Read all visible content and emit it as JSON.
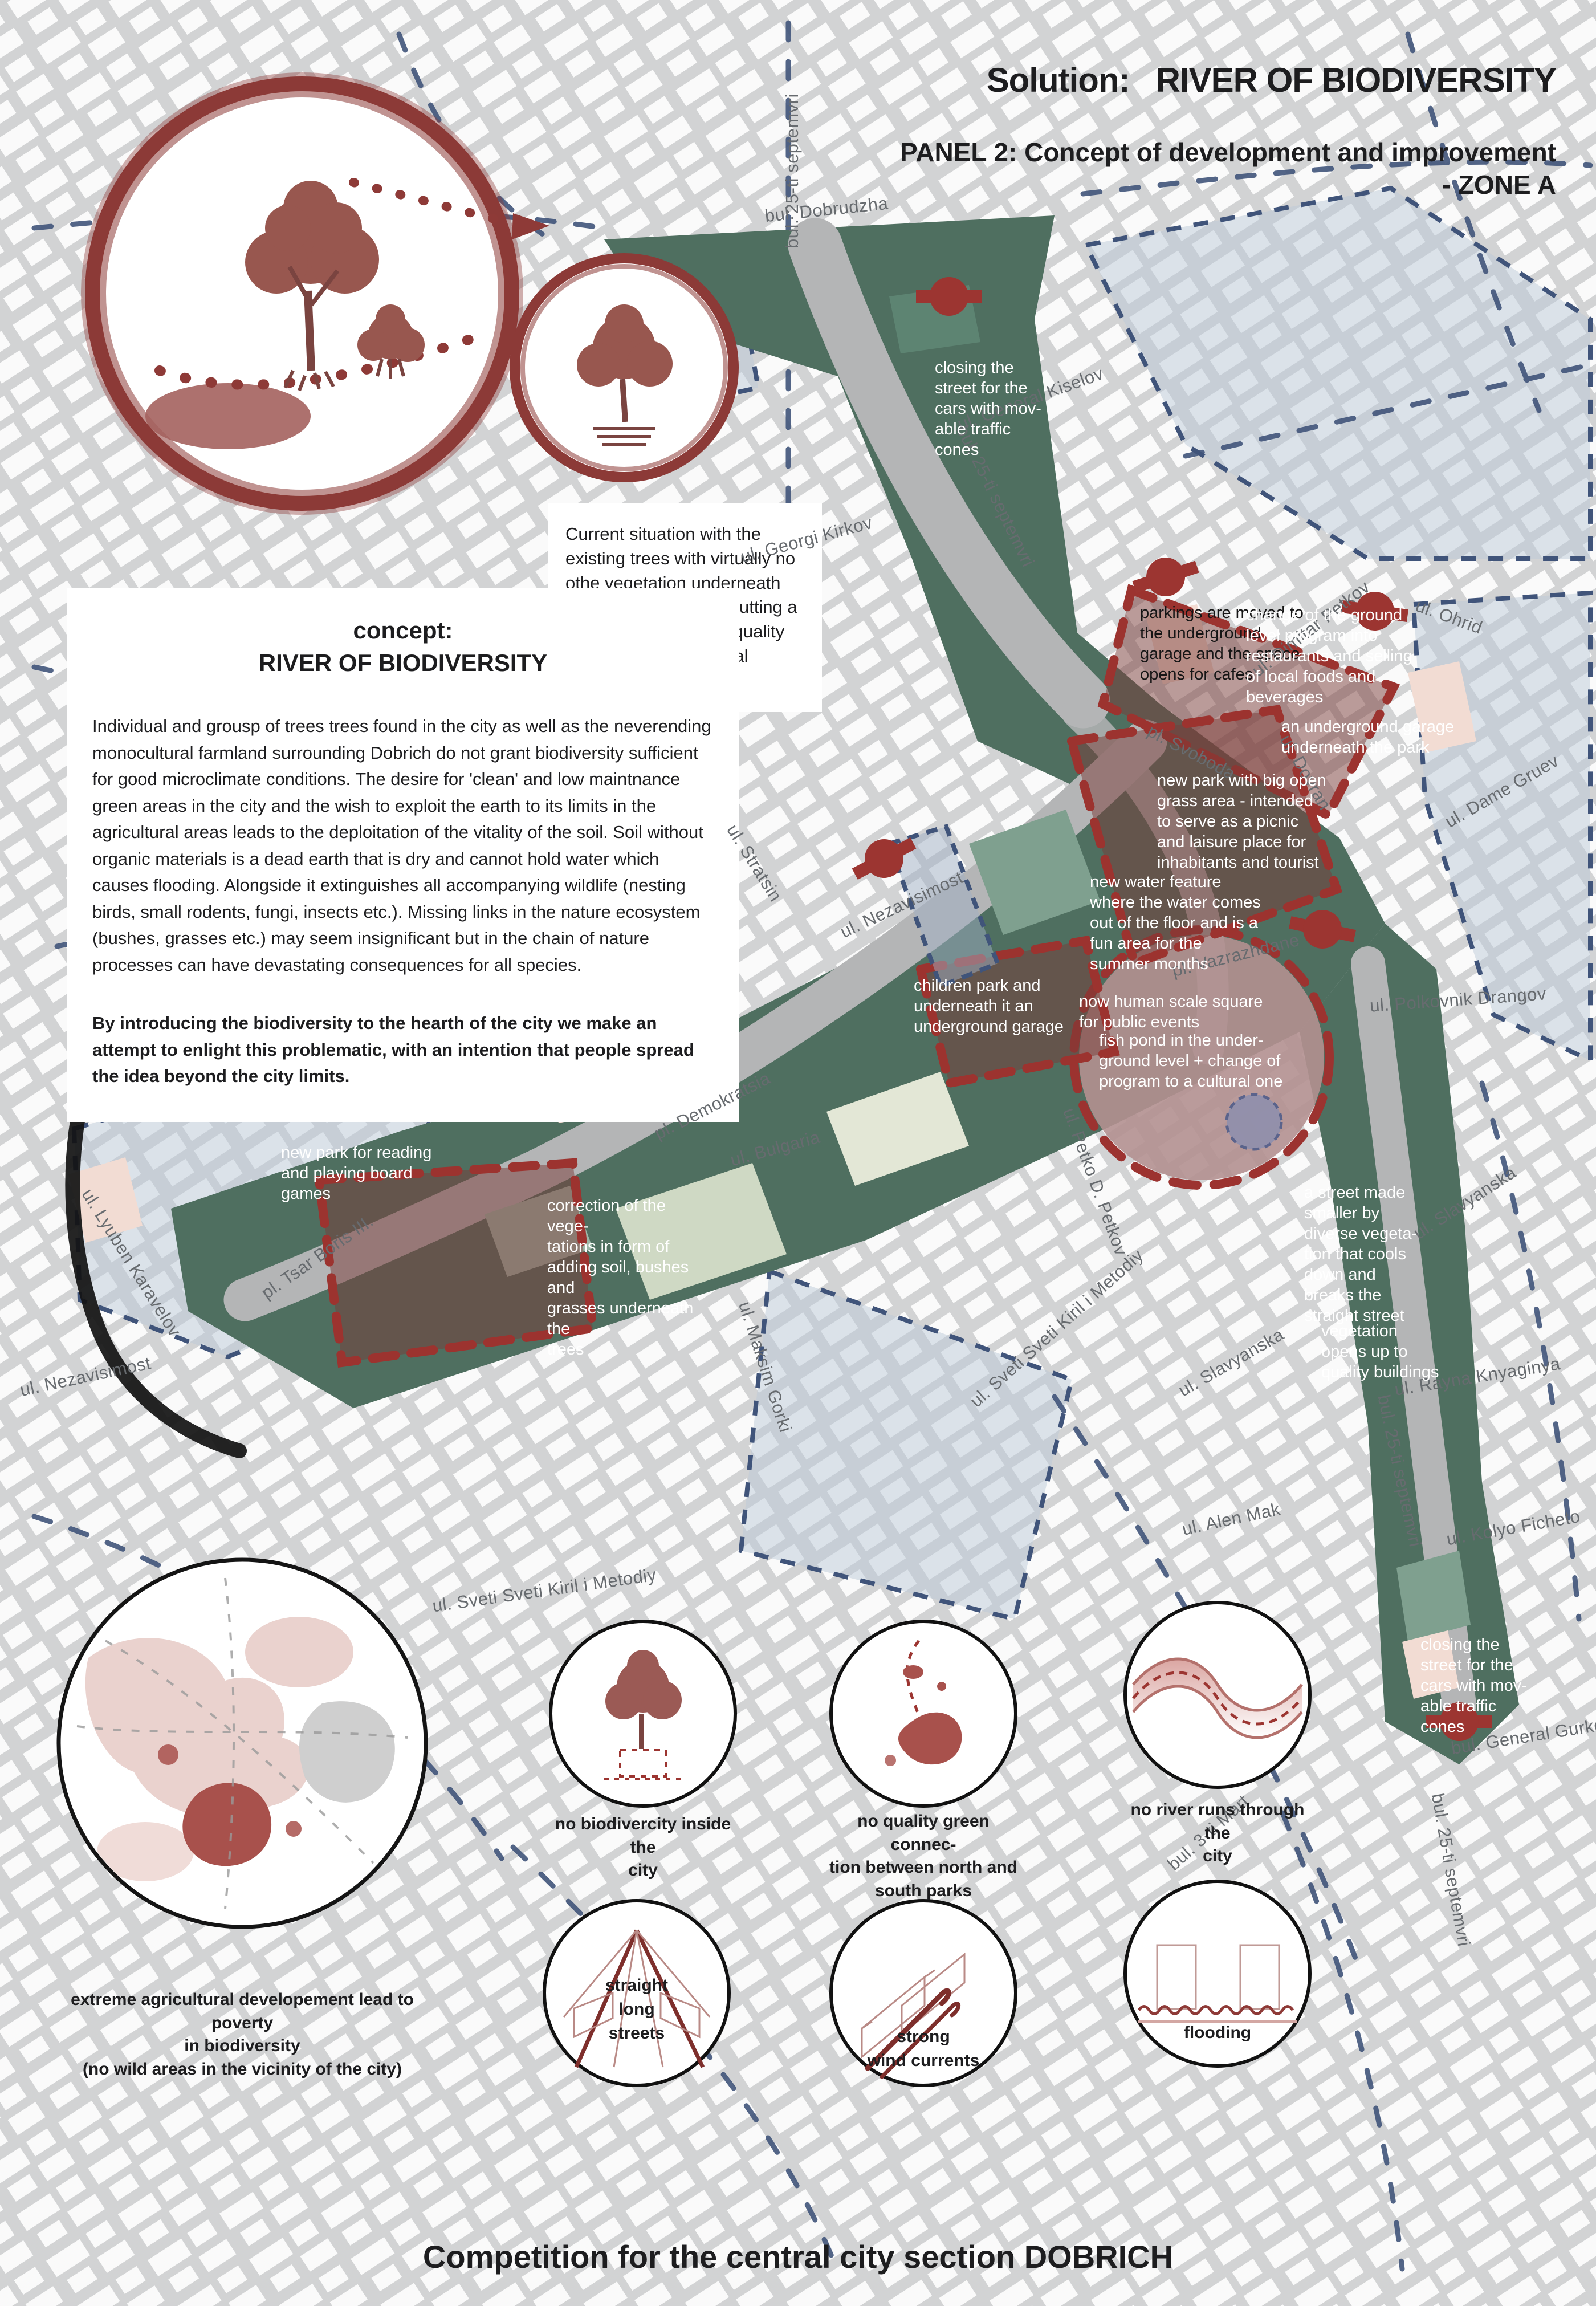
{
  "header": {
    "solution_label": "Solution:",
    "solution_title": "RIVER OF BIODIVERSITY",
    "panel_line": "PANEL 2: Concept of development and improvement",
    "zone_line": "- ZONE A"
  },
  "concept": {
    "heading": "concept:\nRIVER OF BIODIVERSITY",
    "body": "Individual and grousp of trees trees found in the city as well as the neverending monocultural farmland surrounding Dobrich do not grant biodiversity sufficient for good microclimate conditions. The desire for 'clean' and low maintnance green areas in the city and the wish to exploit the earth to its limits in the agricultural areas leads to the deploitation of the vitality of the soil. Soil without organic materials is a dead earth that is dry and cannot hold water which causes flooding. Alongside it extinguishes all accompanying wildlife (nesting birds, small rodents, fungi, insects etc.). Missing links in the nature ecosystem (bushes, grasses etc.) may seem insignificant but in the chain of nature processes can have devastating consequences for all species.",
    "emphasis": "By introducing the biodiversity to the hearth of the city we make an attempt to enlight this problematic, with an intention that people spread the idea beyond the city limits."
  },
  "notes": {
    "current_situation": "Current situation with the existing trees with virtually no othe vegetation underneath them is corrected by putting a foil and 15cm of high quality soil, alongside the local bushes and grasses."
  },
  "map": {
    "annotations": [
      {
        "text": "closing the\nstreet for the\ncars with mov-\nable traffic\ncones",
        "tone": "light"
      },
      {
        "text": "parkings are moved to\nthe underground\ngarage and the space\nopens for cafes",
        "tone": "dark"
      },
      {
        "text": "change of the ground\nlevel program into\nrestaurants and selling\nof local foods and\nbeverages",
        "tone": "light"
      },
      {
        "text": "an underground garage\nunderneath the park",
        "tone": "light"
      },
      {
        "text": "new park with big open\ngrass area - intended\nto serve as a picnic\nand laisure place for\ninhabitants and tourist",
        "tone": "light"
      },
      {
        "text": "new water feature\nwhere the water comes\nout of the floor and is a\nfun area for the\nsummer months",
        "tone": "light"
      },
      {
        "text": "children park and\nunderneath it an\nunderground garage",
        "tone": "light"
      },
      {
        "text": "now human scale square\nfor public events",
        "tone": "light"
      },
      {
        "text": "fish pond in the under-\nground level + change of\nprogram to a cultural one",
        "tone": "light"
      },
      {
        "text": "new park for reading\nand playing board\ngames",
        "tone": "light"
      },
      {
        "text": "correction of the vege-\ntations in form of\nadding soil, bushes and\ngrasses underneath the\ntrees",
        "tone": "light"
      },
      {
        "text": "a street made\nsmaller by\ndiverse vegeta-\ntion that cools\ndown and\nbreaks the\nstraight street",
        "tone": "light"
      },
      {
        "text": "vegetation\nopens up to\nquality buildings",
        "tone": "light"
      },
      {
        "text": "closing the\nstreet for the\ncars with mov-\nable traffic\ncones",
        "tone": "light"
      }
    ],
    "street_labels": [
      "bul. 25-ti septemvri",
      "bul. Dobrudzha",
      "ul. Georgi Kirkov",
      "ul. General Kiselov",
      "bul. 25-ti septemvri",
      "ul. Dimitar Petkov",
      "ul. Ohrid",
      "ul. Dame Gruev",
      "pl. Svoboda",
      "ul. Doyran",
      "pl. Vazrazhdane",
      "ul. Polkovnik Drangov",
      "ul. Stratsin",
      "ul. Nezavisimost",
      "pl. Demokratsia",
      "ul. Bulgaria",
      "ul. Petko D. Petkov",
      "ul. Maksim Gorki",
      "ul. Sveti Sveti Kiril i Metodiy",
      "ul. Slavyanska",
      "ul. Rayna Knyaginya",
      "ul. Alen Mak",
      "ul. Kolyo Ficheto",
      "bul. 25-ti septemvri",
      "bul. General Gurko",
      "bul. 3-ti Mart",
      "ul. Sveti Sveti Kiril i Metodiy",
      "ul. Nezavisimost",
      "ul. Lyuben Karavelov",
      "pl. Tsar Boris III.",
      "ul. Slavyanska",
      "bul. 25-ti septemvri"
    ]
  },
  "insets": {
    "problems": [
      {
        "caption": "no biodivercity inside the\ncity"
      },
      {
        "caption": "no quality green connec-\ntion between north and\nsouth parks"
      },
      {
        "caption": "no river runs through the\ncity"
      }
    ],
    "big_circle_caption": "extreme agricultural developement lead to poverty\nin biodiversity\n(no wild areas in the vicinity of the city)",
    "sketches": [
      {
        "label": "straight\nlong\nstreets"
      },
      {
        "label": "strong\nwind currents"
      },
      {
        "label": "flooding"
      }
    ]
  },
  "footer": {
    "title": "Competition for the central city section DOBRICH"
  },
  "colors": {
    "park_green": "#4f6f60",
    "accent_red": "#9c3531",
    "overlay_redbrown": "rgba(122,60,56,0.5)",
    "navy_dash": "#40547a",
    "street_label_gray": "#676b6f",
    "square_mauve": "#b29090"
  }
}
